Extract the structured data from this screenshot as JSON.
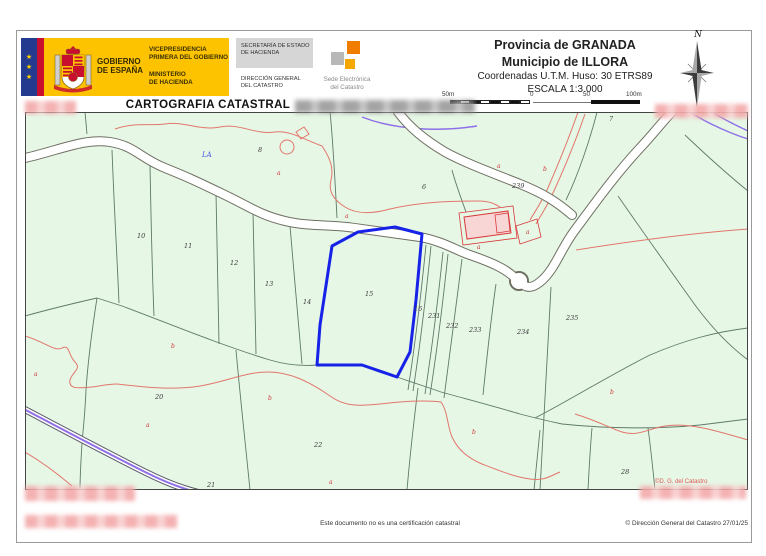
{
  "header": {
    "government_logo": {
      "stars": [
        "★",
        "★",
        "★"
      ],
      "gobierno": [
        "GOBIERNO",
        "DE ESPAÑA"
      ],
      "vicepresidencia": [
        "VICEPRESIDENCIA",
        "PRIMERA DEL GOBIERNO"
      ],
      "ministerio": [
        "MINISTERIO",
        "DE HACIENDA"
      ],
      "secretaria": [
        "SECRETARÍA DE ESTADO",
        "DE HACIENDA"
      ],
      "direccion": [
        "DIRECCIÓN GENERAL",
        "DEL CATASTRO"
      ],
      "sede": [
        "Sede Electrónica",
        "del Catastro"
      ]
    },
    "location": {
      "province": "Provincia de GRANADA",
      "municipality": "Municipio de ILLORA",
      "coordinates": "Coordenadas U.T.M. Huso: 30 ETRS89",
      "scale": "ESCALA 1:3.000",
      "scalebar": [
        "50m",
        "0",
        "50",
        "100m"
      ]
    },
    "compass_label": "N"
  },
  "title": "CARTOGRAFIA CATASTRAL",
  "map": {
    "highlighted_parcel": "15",
    "name_labels": [
      {
        "t": "LA",
        "x": 202,
        "y": 157
      }
    ],
    "parcel_labels": [
      {
        "t": "7",
        "x": 609,
        "y": 121
      },
      {
        "t": "8",
        "x": 258,
        "y": 152
      },
      {
        "t": "6",
        "x": 422,
        "y": 189
      },
      {
        "t": "239",
        "x": 512,
        "y": 188
      },
      {
        "t": "10",
        "x": 137,
        "y": 238
      },
      {
        "t": "11",
        "x": 184,
        "y": 248
      },
      {
        "t": "12",
        "x": 230,
        "y": 265
      },
      {
        "t": "13",
        "x": 265,
        "y": 286
      },
      {
        "t": "14",
        "x": 303,
        "y": 304
      },
      {
        "t": "15",
        "x": 365,
        "y": 296
      },
      {
        "t": "16",
        "x": 414,
        "y": 311
      },
      {
        "t": "231",
        "x": 428,
        "y": 318
      },
      {
        "t": "232",
        "x": 446,
        "y": 328
      },
      {
        "t": "233",
        "x": 469,
        "y": 332
      },
      {
        "t": "234",
        "x": 517,
        "y": 334
      },
      {
        "t": "235",
        "x": 566,
        "y": 320
      },
      {
        "t": "20",
        "x": 155,
        "y": 399
      },
      {
        "t": "22",
        "x": 314,
        "y": 447
      },
      {
        "t": "21",
        "x": 207,
        "y": 487
      },
      {
        "t": "28",
        "x": 621,
        "y": 474
      }
    ],
    "subparcel_letters": [
      {
        "t": "a",
        "x": 277,
        "y": 175
      },
      {
        "t": "a",
        "x": 345,
        "y": 218
      },
      {
        "t": "a",
        "x": 497,
        "y": 168
      },
      {
        "t": "b",
        "x": 543,
        "y": 171
      },
      {
        "t": "a",
        "x": 477,
        "y": 249
      },
      {
        "t": "a",
        "x": 526,
        "y": 234
      },
      {
        "t": "b",
        "x": 171,
        "y": 348
      },
      {
        "t": "a",
        "x": 34,
        "y": 376
      },
      {
        "t": "a",
        "x": 146,
        "y": 427
      },
      {
        "t": "b",
        "x": 268,
        "y": 400
      },
      {
        "t": "a",
        "x": 329,
        "y": 484
      },
      {
        "t": "b",
        "x": 472,
        "y": 434
      },
      {
        "t": "b",
        "x": 610,
        "y": 394
      }
    ],
    "watermark": "©D. G. del Catastro",
    "colors": {
      "background": "#e6f7e6",
      "boundary": "#5f7a68",
      "road_casing": "#6f6f63",
      "red_line": "#e2766a",
      "building_fill": "#f8d6d6",
      "building_stroke": "#d93a3a",
      "highlight": "#1722e8",
      "hydro_purple": "#8f6fe8",
      "label": "#3a3a3a",
      "letter": "#cc3333"
    }
  },
  "footer": {
    "disclaimer": "Este documento no es una certificación catastral",
    "copyright": "© Dirección General del Catastro 27/01/25"
  }
}
